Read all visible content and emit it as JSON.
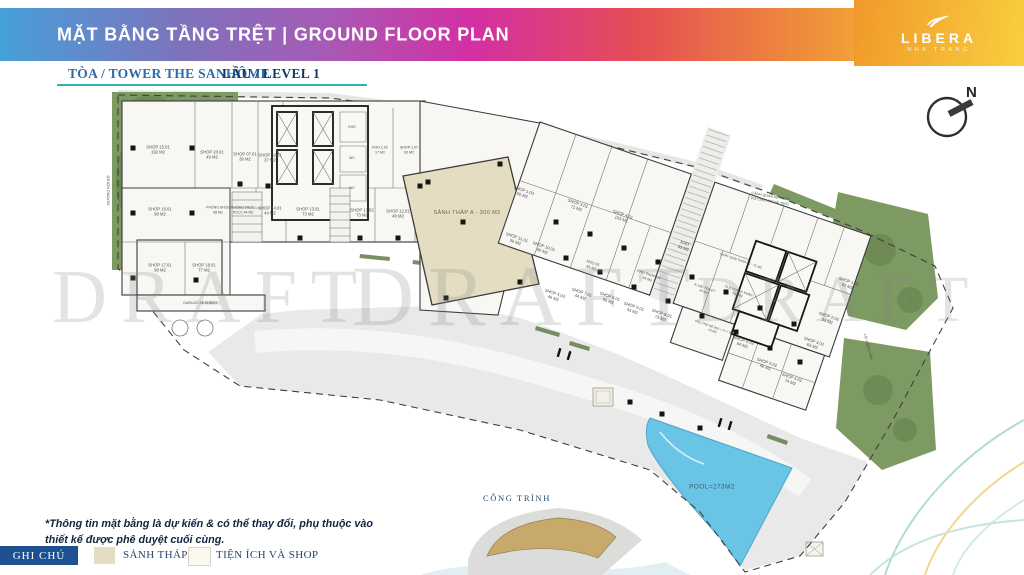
{
  "header": {
    "title": "MẶT BẰNG TẦNG TRỆT | GROUND FLOOR PLAN"
  },
  "logo": {
    "name": "LIBERA",
    "tagline": "NHA TRANG"
  },
  "subheader": {
    "tower": "TÒA / TOWER THE SANHÔME",
    "level": "LẦU / LEVEL 1"
  },
  "compass": {
    "north": "N"
  },
  "watermark": {
    "text": "DRAFT"
  },
  "plan": {
    "lobby": {
      "label": "SẢNH THÁP A - 300 M2"
    },
    "pool": {
      "label": "POOL=273M2"
    },
    "site_key": {
      "label": "CÔNG TRÌNH"
    },
    "units": [
      {
        "t": "SHOP 15.01",
        "a": "192 M2",
        "x": 158,
        "y": 150
      },
      {
        "t": "SHOP 20.01",
        "a": "49 M2",
        "x": 212,
        "y": 155
      },
      {
        "t": "SHOP 07.01",
        "a": "39 M2",
        "x": 245,
        "y": 157
      },
      {
        "t": "SHOP 32.01",
        "a": "37 M2",
        "x": 270,
        "y": 158
      },
      {
        "t": "KHO",
        "x": 352,
        "y": 127,
        "s": 3.4
      },
      {
        "t": "WC",
        "x": 352,
        "y": 158,
        "s": 3.4
      },
      {
        "t": "WC",
        "x": 352,
        "y": 188,
        "s": 3.4
      },
      {
        "t": "KHO 1.02",
        "a": "17 M2",
        "x": 380,
        "y": 150,
        "s": 3.6
      },
      {
        "t": "SHOP 1.07",
        "a": "63 M2",
        "x": 409,
        "y": 150,
        "s": 3.6
      },
      {
        "t": "SHOP 16.01",
        "a": "98 M2",
        "x": 160,
        "y": 212
      },
      {
        "t": "PHÒNG SHCĐ",
        "a": "58 M2",
        "x": 218,
        "y": 210,
        "s": 3.5
      },
      {
        "t": "PHÒNG TRỰC",
        "a": "PCCC 44 M2",
        "x": 243,
        "y": 210,
        "s": 3.5
      },
      {
        "t": "SHOP 14.01",
        "a": "44 M2",
        "x": 270,
        "y": 211
      },
      {
        "t": "SHOP 13.01",
        "a": "73 M2",
        "x": 308,
        "y": 212
      },
      {
        "t": "SHOP 13.02",
        "a": "73 M2",
        "x": 362,
        "y": 213
      },
      {
        "t": "SHOP 12.01",
        "a": "48 M2",
        "x": 398,
        "y": 214
      },
      {
        "t": "SHOP 17.01",
        "a": "98 M2",
        "x": 160,
        "y": 268
      },
      {
        "t": "SHOP 18.01",
        "a": "77 M2",
        "x": 204,
        "y": 268
      },
      {
        "t": "SHOP 1.03",
        "a": "50 M2",
        "x": 523,
        "y": 193,
        "r": 19
      },
      {
        "t": "SHOP 3.01",
        "a": "71 M2",
        "x": 577,
        "y": 206,
        "r": 19
      },
      {
        "t": "SHOP 4.01",
        "a": "103 M2",
        "x": 622,
        "y": 217,
        "r": 19
      },
      {
        "t": "SHOP 11.01",
        "a": "50 M2",
        "x": 516,
        "y": 240,
        "r": 19
      },
      {
        "t": "SHOP 10.01",
        "a": "50 M2",
        "x": 543,
        "y": 249,
        "r": 19
      },
      {
        "t": "KHO",
        "a": "33 M2",
        "x": 684,
        "y": 246,
        "r": 19
      },
      {
        "t": "KHO SHOP 2A",
        "a": "94 M2",
        "x": 648,
        "y": 277,
        "r": 19,
        "s": 3.6
      },
      {
        "t": "KHO 05",
        "a": "55 M2",
        "x": 592,
        "y": 266,
        "r": 19,
        "s": 3.8
      },
      {
        "t": "SHOP 4.03",
        "a": "46 M2",
        "x": 554,
        "y": 296,
        "r": 19
      },
      {
        "t": "SHOP 7.01",
        "a": "44 M2",
        "x": 581,
        "y": 295,
        "r": 19
      },
      {
        "t": "SHOP 6.01",
        "a": "55 M2",
        "x": 609,
        "y": 299,
        "r": 19
      },
      {
        "t": "SHOP 9.01",
        "a": "43 M2",
        "x": 633,
        "y": 309,
        "r": 19
      },
      {
        "t": "SHOP 8.01",
        "a": "73 M2",
        "x": 661,
        "y": 316,
        "r": 19
      },
      {
        "t": "QUẦY ĐÓN THÁP B2 - 71 M2",
        "x": 741,
        "y": 261,
        "r": 19,
        "s": 3.3
      },
      {
        "t": "A. WC TOILET",
        "a": "45 M2",
        "x": 704,
        "y": 290,
        "r": 19,
        "s": 3.3
      },
      {
        "t": "CLB DOANH NHÂN",
        "a": "100 M2",
        "x": 738,
        "y": 293,
        "r": 19,
        "s": 3.3
      },
      {
        "t": "PHỤ TRỢ BỂ BƠI + P. Y TẾ",
        "a": "43 M2",
        "x": 713,
        "y": 329,
        "r": 19,
        "s": 3.1
      },
      {
        "t": "SHOP 6.02",
        "a": "64 M2",
        "x": 743,
        "y": 343,
        "r": 19
      },
      {
        "t": "SHOP 5.02",
        "a": "46 M2",
        "x": 766,
        "y": 365,
        "r": 19
      },
      {
        "t": "SHOP 4.02",
        "a": "74 M2",
        "x": 791,
        "y": 380,
        "r": 19
      },
      {
        "t": "SHOP 3.02",
        "a": "63 M2",
        "x": 813,
        "y": 344,
        "r": 19
      },
      {
        "t": "SHOP 2.02",
        "a": "53 M2",
        "x": 828,
        "y": 319,
        "r": 19
      },
      {
        "t": "SHOP 1.02",
        "a": "53 M2",
        "x": 848,
        "y": 284,
        "r": 19
      },
      {
        "t": "CẢNH QUAN KẾT HỢP",
        "a": "VUI CHƠI NGOÀI TRỜI",
        "x": 770,
        "y": 199,
        "r": 10,
        "s": 3.6
      },
      {
        "t": "GARA ĐỖ XE KHÁCH",
        "x": 200,
        "y": 303,
        "s": 3.4
      },
      {
        "t": "ĐƯỜNG NỘI BỘ",
        "x": 109,
        "y": 190,
        "r": -90,
        "s": 3.8
      },
      {
        "t": "LỐI XUỐNG HẦM",
        "x": 868,
        "y": 347,
        "r": 75,
        "s": 3.3
      }
    ]
  },
  "disclaimer": {
    "text": "*Thông tin mặt bằng là dự kiến & có thể thay đổi, phụ thuộc vào thiết kế được phê duyệt cuối cùng."
  },
  "legend": {
    "title": "GHI CHÚ",
    "items": [
      {
        "label": "SẢNH THÁP A",
        "color": "#e4ddc2"
      },
      {
        "label": "TIỆN ÍCH VÀ SHOP",
        "color": "#faf8ef"
      }
    ]
  },
  "colors": {
    "header_gradient": [
      "#46a0d9",
      "#a75ab5",
      "#d42fa4",
      "#e54d55",
      "#ee8b3b",
      "#f6cc35"
    ],
    "logo_panel": [
      "#f0992a",
      "#f9cf3e"
    ],
    "accent_teal": "#35b3aa",
    "legend_navy": "#1d5191",
    "pool_blue": "#6ac4e6",
    "lobby_beige": "#e4ddc2",
    "landscape_green": "#7d9a62"
  }
}
